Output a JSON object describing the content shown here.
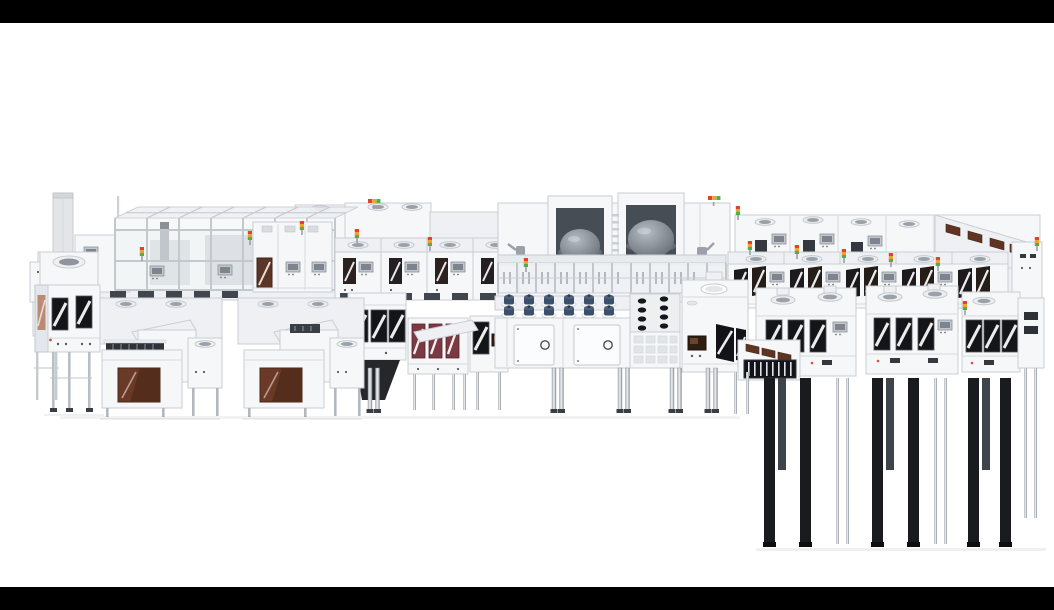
{
  "scene": {
    "type": "isometric-3d-render",
    "subject": "Long modular semiconductor lithography / wafer-fab production line rendered in white on a plain background, letterboxed with black bars",
    "background_color": "#ffffff",
    "letterbox": {
      "color": "#000000",
      "top_height_px": 23,
      "bottom_height_px": 23
    }
  },
  "palette": {
    "module_white": "#f6f7f9",
    "module_shade": "#eef0f3",
    "outline_gray": "#c8cdd2",
    "glass_tint": "#eef1f4",
    "window_black": "#141519",
    "window_brown": "#6b3a26",
    "window_maroon": "#7b3a41",
    "door_brown": "#5d3526",
    "dome_gray": "#7b828a",
    "knob_navy": "#3b4f68",
    "chrome_leg": "#c3c7cc",
    "dark_leg": "#1a1b1e",
    "skirt_dark": "#26272b",
    "indicator_red": "#e0422f",
    "indicator_amber": "#f0a229",
    "indicator_green": "#4caf50"
  },
  "machine": {
    "sections": [
      {
        "id": "exhaust-stack",
        "label": "exhaust stack and service poles"
      },
      {
        "id": "glass-canopy",
        "label": "glass-framed canopy bay with interior equipment"
      },
      {
        "id": "filter-unit",
        "label": "filter unit with roof vents and brown access door"
      },
      {
        "id": "left-cabinet",
        "label": "left cabinet with dark striped windows"
      },
      {
        "id": "loadport-row",
        "label": "foreground load-port module clusters with brown windows",
        "count": 3
      },
      {
        "id": "mid-track-modules",
        "label": "mid track modules with dark and maroon striped windows",
        "count": 4
      },
      {
        "id": "striped-cabinet",
        "label": "center-left cabinet with dark skirt and chrome legs"
      },
      {
        "id": "maroon-module",
        "label": "module with three maroon striped windows"
      },
      {
        "id": "process-chambers",
        "label": "twin process chambers with gray domes",
        "dome_count": 2
      },
      {
        "id": "glass-conveyor",
        "label": "glazed transfer conveyor with mullions"
      },
      {
        "id": "valve-console",
        "label": "valve console deck",
        "knob_rows": 2,
        "knob_columns": 6,
        "porthole_doors": 2
      },
      {
        "id": "holes-deck",
        "label": "perforated deck with port holes"
      },
      {
        "id": "interface-tower",
        "label": "interface tower with oval roof port and striped windows"
      },
      {
        "id": "right-track-rows",
        "label": "right track section",
        "rows": 3
      },
      {
        "id": "vent-grille-unit",
        "label": "black vent grille unit with brown hatches"
      },
      {
        "id": "support-legs",
        "label": "chrome and black support legs"
      }
    ],
    "indicator_lights": {
      "style": "stack light towers",
      "colors_top_to_bottom": [
        "#e0422f",
        "#f0a229",
        "#4caf50"
      ],
      "count": 16
    }
  }
}
